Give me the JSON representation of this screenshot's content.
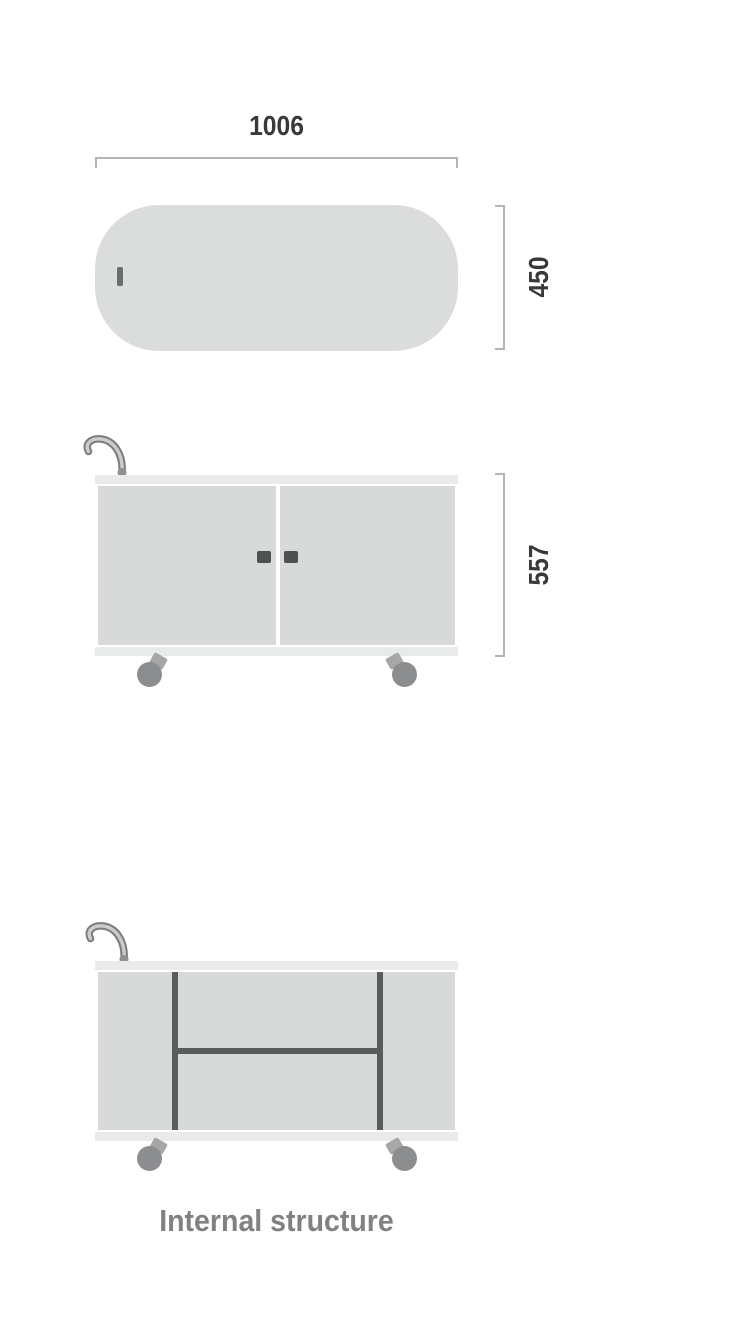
{
  "diagram": {
    "caption": "Internal structure",
    "dimensions": {
      "width": "1006",
      "depth": "450",
      "height": "557"
    },
    "views": {
      "top_view": {
        "shape": "rounded-pill",
        "width_label": "1006",
        "depth_label": "450"
      },
      "front_view": {
        "doors": 2,
        "height_label": "557"
      },
      "internal_view": {
        "caption": "Internal structure",
        "vertical_dividers": 2,
        "shelves": 1
      }
    },
    "colors": {
      "panel": "#d8d9d9",
      "rail": "#e9eaea",
      "pill": "#dbdcdc",
      "dimension_line": "#b2b4b5",
      "dimension_text": "#38393b",
      "wheel": "#8b8d8f",
      "internal_line": "#595b5d",
      "door_handle": "#4e5052",
      "caption_text": "#7f8183"
    }
  }
}
